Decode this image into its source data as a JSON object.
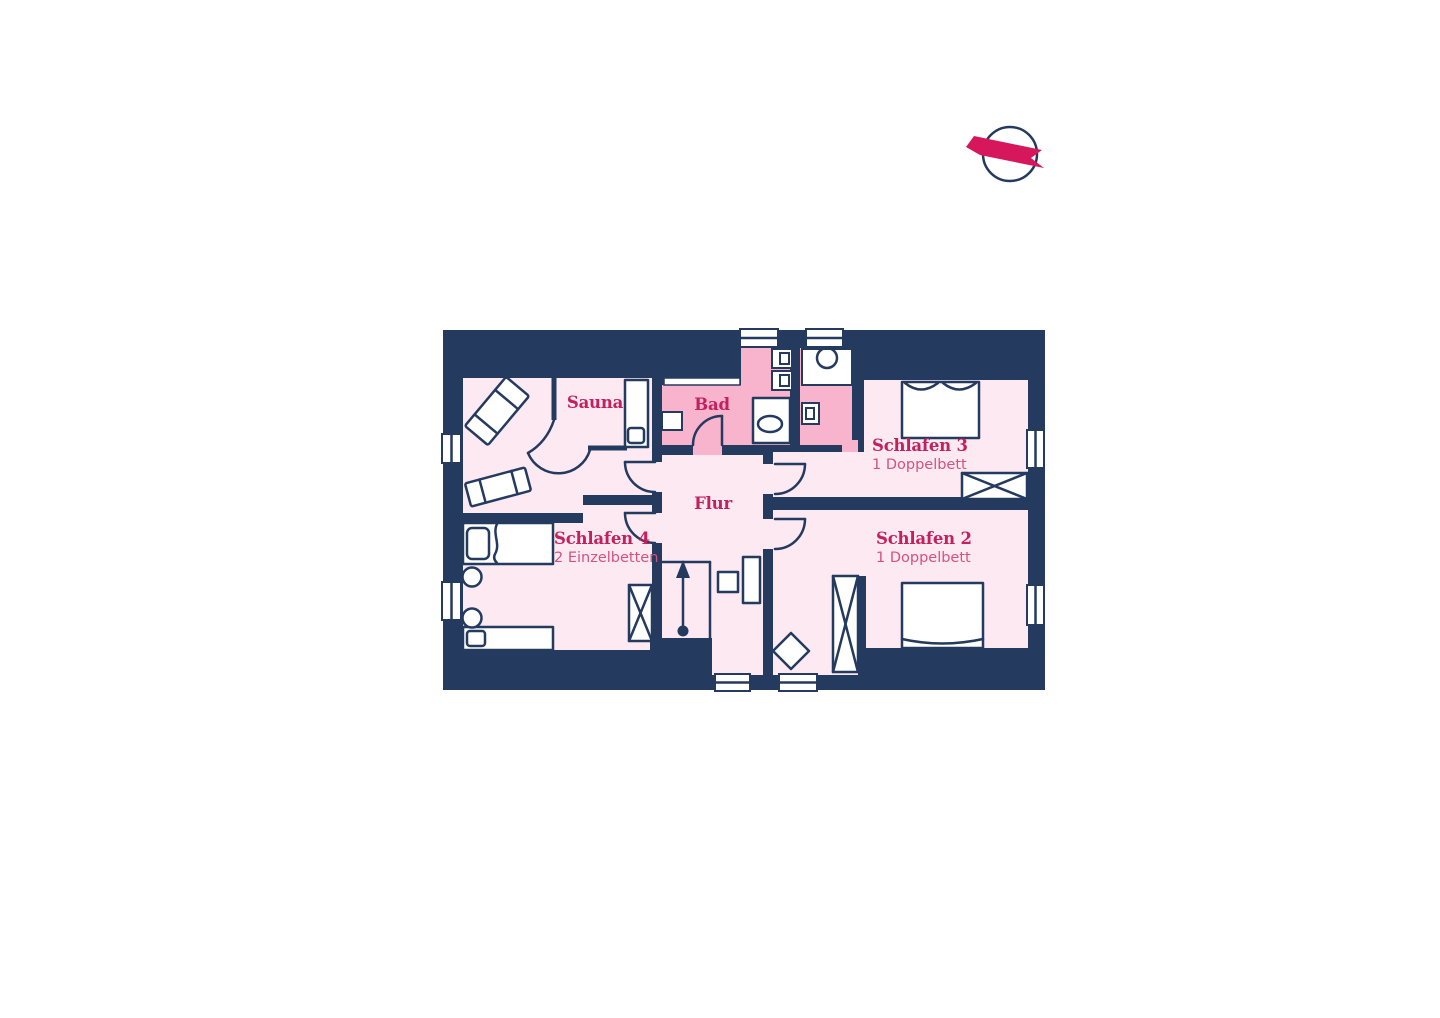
{
  "plan": {
    "name": "floor-plan",
    "colors": {
      "wall_navy": "#243a5e",
      "room_light_pink": "#fce9f1",
      "room_medium_pink": "#f8b4cc",
      "label_accent": "#c2205f",
      "sublabel_accent": "#d5527e",
      "compass_ribbon": "#d6175c"
    },
    "rooms": [
      {
        "id": "sauna",
        "label": "Sauna"
      },
      {
        "id": "bad",
        "label": "Bad"
      },
      {
        "id": "flur",
        "label": "Flur"
      },
      {
        "id": "schlafen-3",
        "label": "Schlafen 3",
        "sublabel": "1 Doppelbett"
      },
      {
        "id": "schlafen-2",
        "label": "Schlafen 2",
        "sublabel": "1 Doppelbett"
      },
      {
        "id": "schlafen-4",
        "label": "Schlafen 4",
        "sublabel": "2 Einzelbetten"
      }
    ],
    "icons": [
      {
        "name": "compass-icon"
      },
      {
        "name": "stairs-up-arrow-icon"
      }
    ]
  }
}
